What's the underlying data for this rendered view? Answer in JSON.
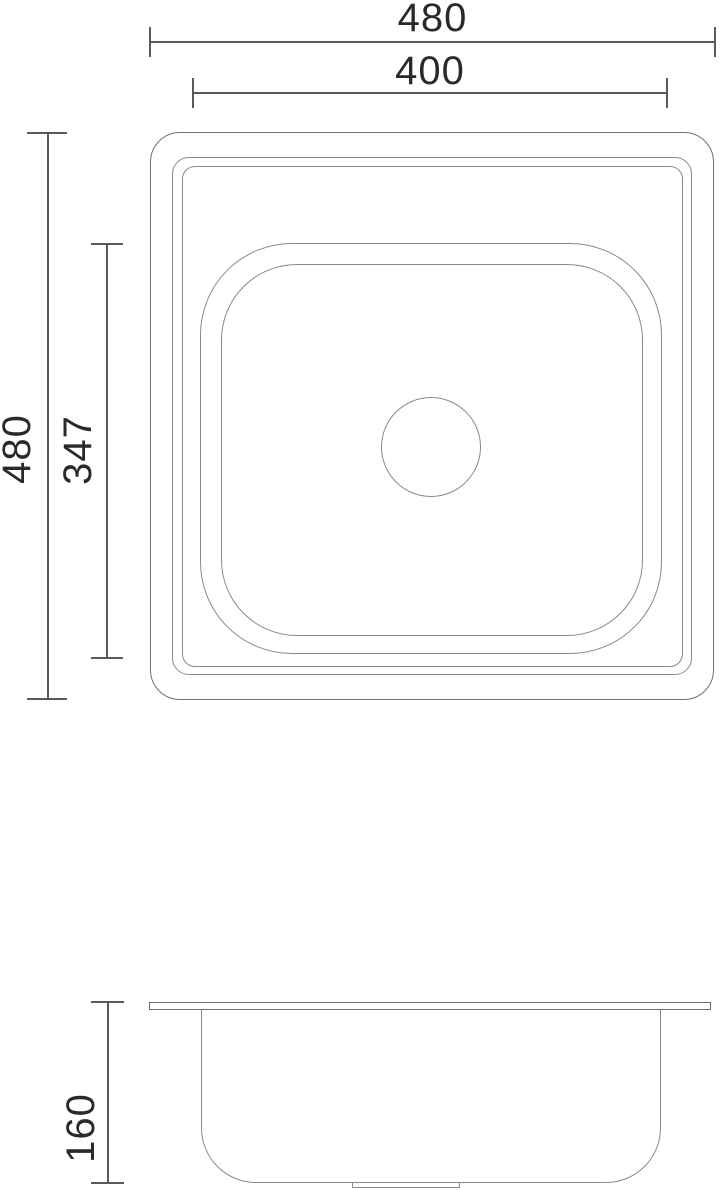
{
  "colors": {
    "background": "#ffffff",
    "outline": "#8a8a8a",
    "dimension_line": "#5a5a5a",
    "dimension_text": "#2a2a2a"
  },
  "top_view": {
    "dimensions": {
      "overall_width": "480",
      "bowl_width": "400",
      "overall_length": "480",
      "bowl_length": "347"
    }
  },
  "side_view": {
    "dimensions": {
      "depth": "160"
    }
  }
}
